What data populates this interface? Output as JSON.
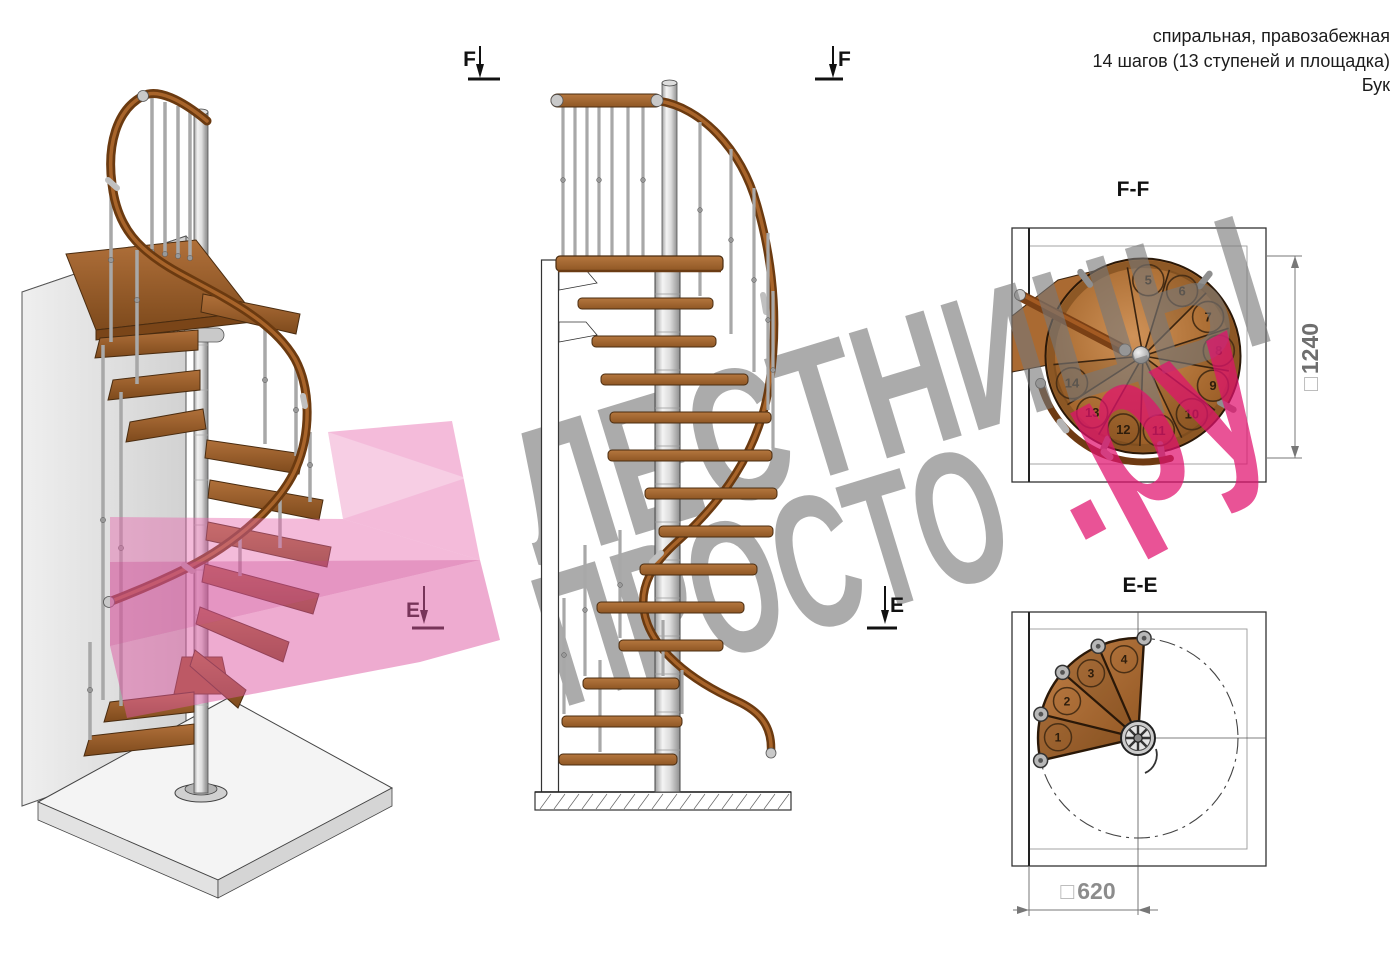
{
  "header": {
    "line1": "спиральная, правозабежная",
    "line2": "14 шагов (13 ступеней и площадка)",
    "line3": "Бук"
  },
  "sections": {
    "ff": {
      "title": "F-F",
      "dim_square": "□",
      "dim_value": "1240",
      "steps": [
        "5",
        "6",
        "7",
        "8",
        "9",
        "10",
        "11",
        "12",
        "13",
        "14"
      ]
    },
    "ee": {
      "title": "E-E",
      "dim_square": "□",
      "dim_value": "620",
      "steps": [
        "1",
        "2",
        "3",
        "4"
      ]
    }
  },
  "markers": {
    "f_left": "F",
    "f_right": "F",
    "e_left": "E",
    "e_right": "E"
  },
  "watermark": {
    "line1": "ЛЕСТНИЦЫ",
    "line2_gray": "ПРОСТО",
    "line2_pink": ".ру",
    "gray_color": "#a5a5a5",
    "pink_color": "#e84282"
  }
}
